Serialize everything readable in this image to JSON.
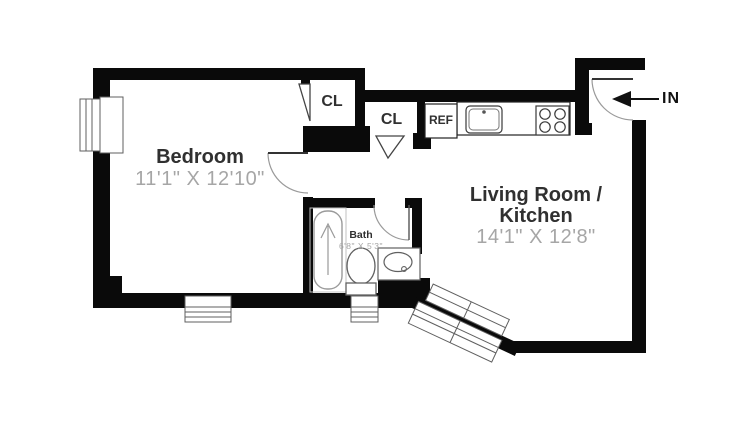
{
  "colors": {
    "wall": "#0a0a0a",
    "roomname": "#303030",
    "dim": "#a6a6a6",
    "fixture": "#606060",
    "fixturelight": "#9a9a9a",
    "arrow": "#111111"
  },
  "rooms": {
    "bedroom": {
      "name": "Bedroom",
      "dimensions": "11'1\" X 12'10\""
    },
    "living": {
      "name_line1": "Living Room /",
      "name_line2": "Kitchen",
      "dimensions": "14'1\" X 12'8\""
    },
    "bath": {
      "name": "Bath",
      "dimensions": "6'8\" X 5'3\""
    },
    "closet1": {
      "label": "CL"
    },
    "closet2": {
      "label": "CL"
    },
    "kitchen": {
      "refrigerator_label": "REF"
    },
    "entrance": {
      "label": "IN"
    }
  },
  "fixtures": [
    "bathtub",
    "toilet",
    "bathroom-sink-vanity",
    "kitchen-sink",
    "stove-burners",
    "refrigerator",
    "window-left",
    "window-bedroom-bottom",
    "window-bath-bottom",
    "window-diagonal",
    "door-entry",
    "door-bedroom",
    "door-bath",
    "door-closet-1",
    "door-closet-2"
  ]
}
